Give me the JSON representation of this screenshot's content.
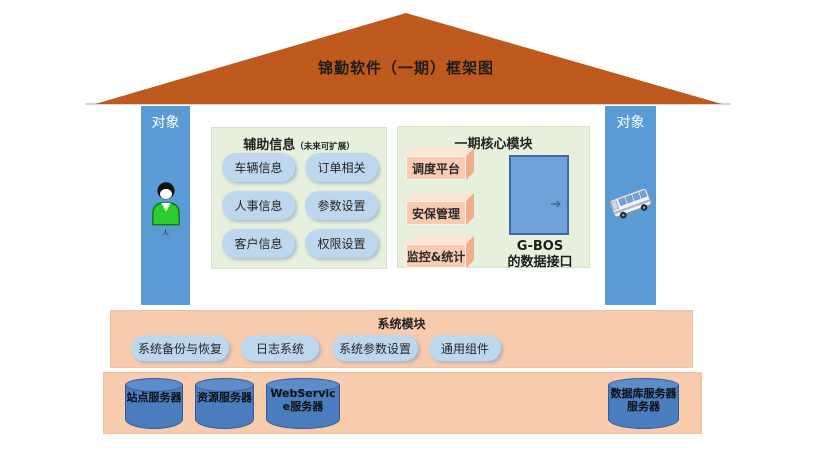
{
  "title": "锦勤软件（一期）框架图",
  "pillars": {
    "left": {
      "label": "对象",
      "icon": "person-icon",
      "caption": "人"
    },
    "right": {
      "label": "对象",
      "icon": "bus-icon"
    }
  },
  "aux_panel": {
    "title": "辅助信息",
    "subtitle": "（未来可扩展）",
    "buttons": [
      "车辆信息",
      "订单相关",
      "人事信息",
      "参数设置",
      "客户信息",
      "权限设置"
    ]
  },
  "core_panel": {
    "title": "一期核心模块",
    "modules": [
      "调度平台",
      "安保管理",
      "监控&统计"
    ],
    "door_label_line1": "G-BOS",
    "door_label_line2": "的数据接口"
  },
  "system_bar": {
    "title": "系统模块",
    "buttons": [
      "系统备份与恢复",
      "日志系统",
      "系统参数设置",
      "通用组件"
    ]
  },
  "server_bar": {
    "servers": [
      "站点服务器",
      "资源服务器",
      "WebService服务器",
      "数据库服务器服务器"
    ]
  },
  "colors": {
    "roof": "#BE5A1E",
    "pillar_blue": "#5B9BD5",
    "panel_green": "#E6F0DC",
    "button_blue": "#BDD7EE",
    "module_orange": "#F9CCB1",
    "bar_peach": "#F8CBAD",
    "cylinder_blue": "#4A7DBE",
    "door_blue": "#6FA3D8"
  }
}
